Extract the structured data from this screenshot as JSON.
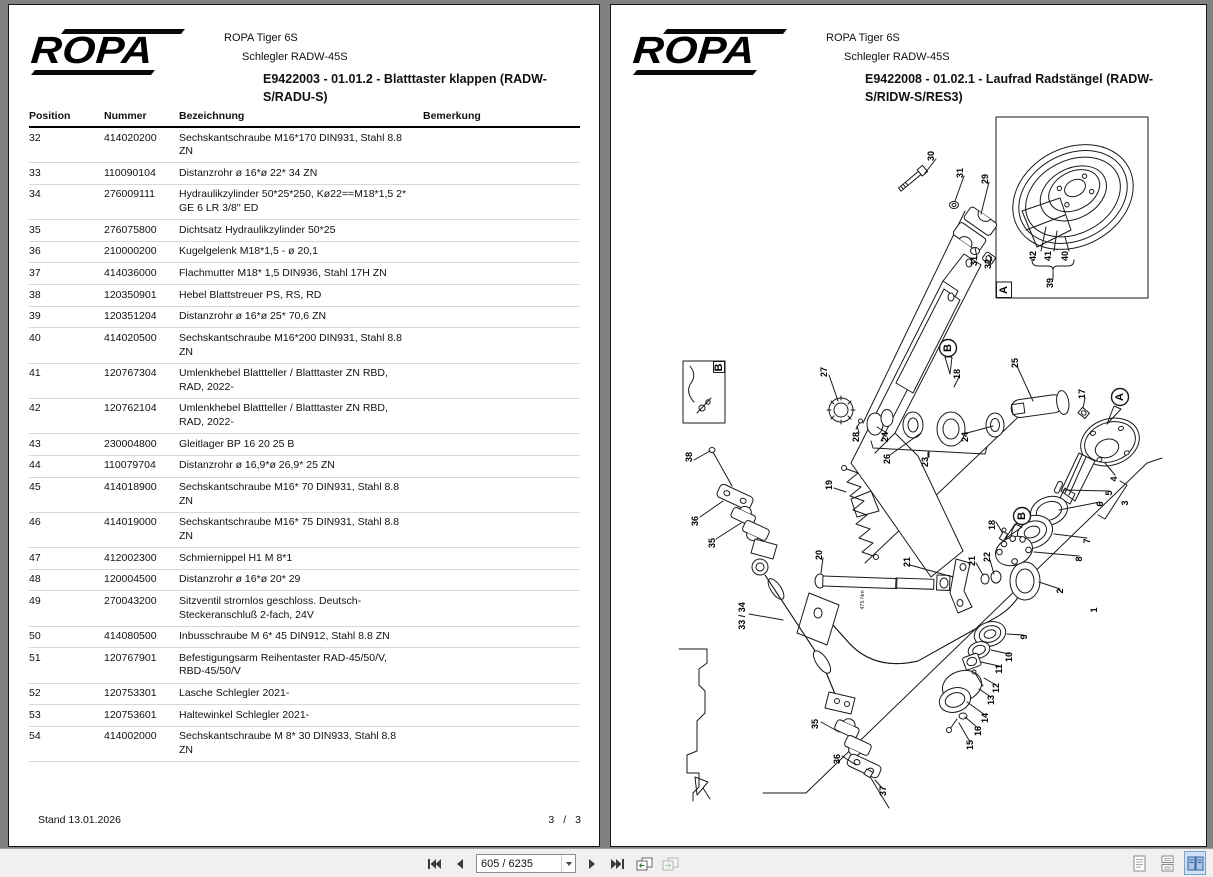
{
  "colors": {
    "app_background": "#818181",
    "page_background": "#ffffff",
    "toolbar_background": "#f1f0ee",
    "selected_layout_accent": "#34629b"
  },
  "left_page": {
    "brand": "ROPA",
    "header_line1": "ROPA Tiger 6S",
    "header_line2": "Schlegler RADW-45S",
    "title": "E9422003 - 01.01.2 - Blatttaster klappen (RADW-S/RADU-S)",
    "table": {
      "columns": [
        "Position",
        "Nummer",
        "Bezeichnung",
        "Bemerkung"
      ],
      "rows": [
        {
          "position": "32",
          "nummer": "414020200",
          "bezeichnung": "Sechskantschraube  M16*170 DIN931, Stahl 8.8 ZN",
          "bemerkung": ""
        },
        {
          "position": "33",
          "nummer": "110090104",
          "bezeichnung": "Distanzrohr  ø 16*ø 22*  34 ZN",
          "bemerkung": ""
        },
        {
          "position": "34",
          "nummer": "276009111",
          "bezeichnung": "Hydraulikzylinder  50*25*250, Kø22==M18*1,5 2* GE  6 LR 3/8'' ED",
          "bemerkung": ""
        },
        {
          "position": "35",
          "nummer": "276075800",
          "bezeichnung": "Dichtsatz Hydraulikzylinder 50*25",
          "bemerkung": ""
        },
        {
          "position": "36",
          "nummer": "210000200",
          "bezeichnung": "Kugelgelenk  M18*1,5 - ø 20,1",
          "bemerkung": ""
        },
        {
          "position": "37",
          "nummer": "414036000",
          "bezeichnung": "Flachmutter  M18*  1,5 DIN936, Stahl 17H ZN",
          "bemerkung": ""
        },
        {
          "position": "38",
          "nummer": "120350901",
          "bezeichnung": "Hebel Blattstreuer PS, RS, RD",
          "bemerkung": ""
        },
        {
          "position": "39",
          "nummer": "120351204",
          "bezeichnung": "Distanzrohr  ø 16*ø 25*  70,6 ZN",
          "bemerkung": ""
        },
        {
          "position": "40",
          "nummer": "414020500",
          "bezeichnung": "Sechskantschraube  M16*200 DIN931, Stahl 8.8 ZN",
          "bemerkung": ""
        },
        {
          "position": "41",
          "nummer": "120767304",
          "bezeichnung": "Umlenkhebel Blattteller / Blatttaster ZN RBD, RAD, 2022-",
          "bemerkung": ""
        },
        {
          "position": "42",
          "nummer": "120762104",
          "bezeichnung": "Umlenkhebel Blattteller / Blatttaster ZN RBD, RAD, 2022-",
          "bemerkung": ""
        },
        {
          "position": "43",
          "nummer": "230004800",
          "bezeichnung": "Gleitlager  BP 16 20 25 B",
          "bemerkung": ""
        },
        {
          "position": "44",
          "nummer": "110079704",
          "bezeichnung": "Distanzrohr  ø 16,9*ø 26,9*  25 ZN",
          "bemerkung": ""
        },
        {
          "position": "45",
          "nummer": "414018900",
          "bezeichnung": "Sechskantschraube  M16* 70 DIN931, Stahl 8.8 ZN",
          "bemerkung": ""
        },
        {
          "position": "46",
          "nummer": "414019000",
          "bezeichnung": "Sechskantschraube  M16* 75 DIN931, Stahl 8.8 ZN",
          "bemerkung": ""
        },
        {
          "position": "47",
          "nummer": "412002300",
          "bezeichnung": "Schmiernippel H1  M 8*1",
          "bemerkung": ""
        },
        {
          "position": "48",
          "nummer": "120004500",
          "bezeichnung": "Distanzrohr  ø 16*ø 20*  29",
          "bemerkung": ""
        },
        {
          "position": "49",
          "nummer": "270043200",
          "bezeichnung": "Sitzventil stromlos geschloss. Deutsch-Steckeranschluß 2-fach, 24V",
          "bemerkung": ""
        },
        {
          "position": "50",
          "nummer": "414080500",
          "bezeichnung": "Inbusschraube  M 6* 45 DIN912, Stahl 8.8 ZN",
          "bemerkung": ""
        },
        {
          "position": "51",
          "nummer": "120767901",
          "bezeichnung": "Befestigungsarm Reihentaster RAD-45/50/V, RBD-45/50/V",
          "bemerkung": ""
        },
        {
          "position": "52",
          "nummer": "120753301",
          "bezeichnung": "Lasche Schlegler 2021-",
          "bemerkung": ""
        },
        {
          "position": "53",
          "nummer": "120753601",
          "bezeichnung": "Haltewinkel Schlegler 2021-",
          "bemerkung": ""
        },
        {
          "position": "54",
          "nummer": "414002000",
          "bezeichnung": "Sechskantschraube  M 8* 30 DIN933, Stahl 8.8 ZN",
          "bemerkung": ""
        }
      ]
    },
    "footer_left": "Stand 13.01.2026",
    "footer_page": "3",
    "footer_sep": "/",
    "footer_total": "3"
  },
  "right_page": {
    "brand": "ROPA",
    "header_line1": "ROPA Tiger 6S",
    "header_line2": "Schlegler RADW-45S",
    "title": "E9422008 - 01.02.1 - Laufrad Radstängel (RADW-S/RIDW-S/RES3)",
    "diagram": {
      "inset_a_label": "A",
      "inset_b_label": "B",
      "torque_note": {
        "text": "475 Nm",
        "x": 251,
        "y": 489
      },
      "markers": [
        {
          "t": "B",
          "x": 335,
          "y": 237
        },
        {
          "t": "A",
          "x": 507,
          "y": 286
        },
        {
          "t": "B",
          "x": 409,
          "y": 405
        }
      ],
      "callouts": [
        {
          "t": "30",
          "x": 321,
          "y": 45
        },
        {
          "t": "31",
          "x": 350,
          "y": 62
        },
        {
          "t": "29",
          "x": 375,
          "y": 68
        },
        {
          "t": "31",
          "x": 364,
          "y": 150
        },
        {
          "t": "32",
          "x": 378,
          "y": 153
        },
        {
          "t": "27",
          "x": 214,
          "y": 261
        },
        {
          "t": "28",
          "x": 246,
          "y": 326
        },
        {
          "t": "24",
          "x": 275,
          "y": 326
        },
        {
          "t": "26",
          "x": 277,
          "y": 348
        },
        {
          "t": "23",
          "x": 315,
          "y": 351
        },
        {
          "t": "24",
          "x": 355,
          "y": 326
        },
        {
          "t": "25",
          "x": 405,
          "y": 252
        },
        {
          "t": "18",
          "x": 347,
          "y": 263
        },
        {
          "t": "19",
          "x": 219,
          "y": 374
        },
        {
          "t": "20",
          "x": 209,
          "y": 444
        },
        {
          "t": "21",
          "x": 297,
          "y": 451
        },
        {
          "t": "38",
          "x": 79,
          "y": 346
        },
        {
          "t": "36",
          "x": 85,
          "y": 410
        },
        {
          "t": "35",
          "x": 102,
          "y": 432
        },
        {
          "t": "17",
          "x": 472,
          "y": 283
        },
        {
          "t": "4",
          "x": 504,
          "y": 368
        },
        {
          "t": "5",
          "x": 499,
          "y": 382
        },
        {
          "t": "6",
          "x": 490,
          "y": 393
        },
        {
          "t": "3",
          "x": 515,
          "y": 392
        },
        {
          "t": "7",
          "x": 477,
          "y": 430
        },
        {
          "t": "8",
          "x": 469,
          "y": 448
        },
        {
          "t": "18",
          "x": 382,
          "y": 414
        },
        {
          "t": "21",
          "x": 362,
          "y": 450
        },
        {
          "t": "22",
          "x": 377,
          "y": 446
        },
        {
          "t": "2",
          "x": 450,
          "y": 480
        },
        {
          "t": "1",
          "x": 484,
          "y": 499
        },
        {
          "t": "9",
          "x": 414,
          "y": 526
        },
        {
          "t": "10",
          "x": 399,
          "y": 546
        },
        {
          "t": "11",
          "x": 389,
          "y": 558
        },
        {
          "t": "12",
          "x": 386,
          "y": 577
        },
        {
          "t": "13",
          "x": 381,
          "y": 589
        },
        {
          "t": "14",
          "x": 375,
          "y": 607
        },
        {
          "t": "16",
          "x": 368,
          "y": 620
        },
        {
          "t": "15",
          "x": 360,
          "y": 634
        },
        {
          "t": "33 / 34",
          "x": 132,
          "y": 505
        },
        {
          "t": "35",
          "x": 205,
          "y": 613
        },
        {
          "t": "36",
          "x": 227,
          "y": 648
        },
        {
          "t": "37",
          "x": 273,
          "y": 680
        },
        {
          "t": "42",
          "x": 423,
          "y": 145
        },
        {
          "t": "41",
          "x": 438,
          "y": 145
        },
        {
          "t": "40",
          "x": 455,
          "y": 145
        },
        {
          "t": "39",
          "x": 440,
          "y": 172
        }
      ]
    }
  },
  "toolbar": {
    "page_field_value": "605 / 6235",
    "icons": [
      "first-page",
      "previous-page",
      "next-page",
      "last-page",
      "previous-view",
      "next-view"
    ],
    "layout_icons": [
      {
        "name": "single-page",
        "selected": false
      },
      {
        "name": "continuous",
        "selected": false
      },
      {
        "name": "facing-pages",
        "selected": true
      }
    ]
  }
}
